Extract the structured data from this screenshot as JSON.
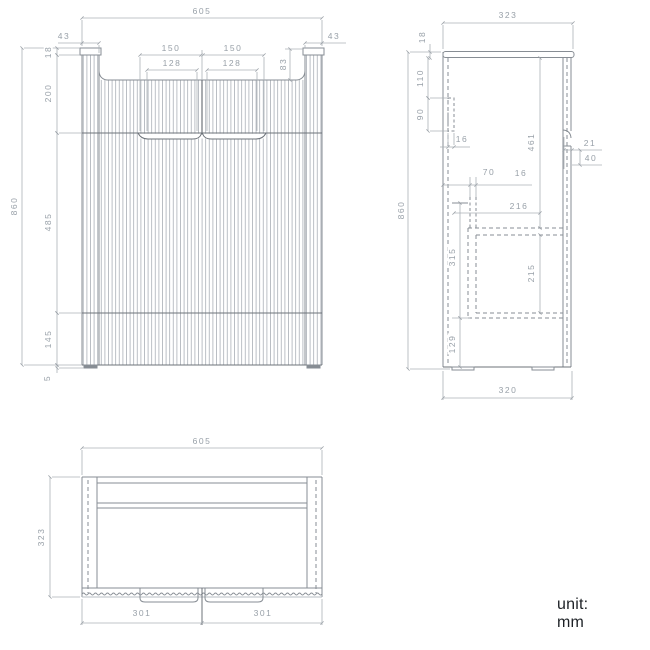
{
  "unit_note": "unit: mm",
  "front_view": {
    "dims": {
      "overall_width": "605",
      "left_panel": "43",
      "right_panel": "43",
      "handle_left": "150",
      "handle_right": "150",
      "handle_left_inner": "128",
      "handle_right_inner": "128",
      "recess_height": "83",
      "cap": "18",
      "top_section": "200",
      "overall_height": "860",
      "middle_section": "485",
      "bottom_section": "145",
      "feet": "5"
    }
  },
  "side_view": {
    "dims": {
      "overall_depth": "323",
      "top_thickness": "18",
      "bracket_offset": "110",
      "bracket_height": "90",
      "bracket_thickness": "16",
      "runner_offset": "70",
      "runner_thickness": "16",
      "front_height": "461",
      "handle_depth": "21",
      "handle_height": "40",
      "overall_height": "860",
      "inner_depth": "216",
      "drawer_zone": "315",
      "drawer_inner": "215",
      "bottom_zone": "129",
      "base_depth": "320"
    }
  },
  "top_view": {
    "dims": {
      "overall_width": "605",
      "overall_depth": "323",
      "left_door": "301",
      "right_door": "301"
    }
  }
}
